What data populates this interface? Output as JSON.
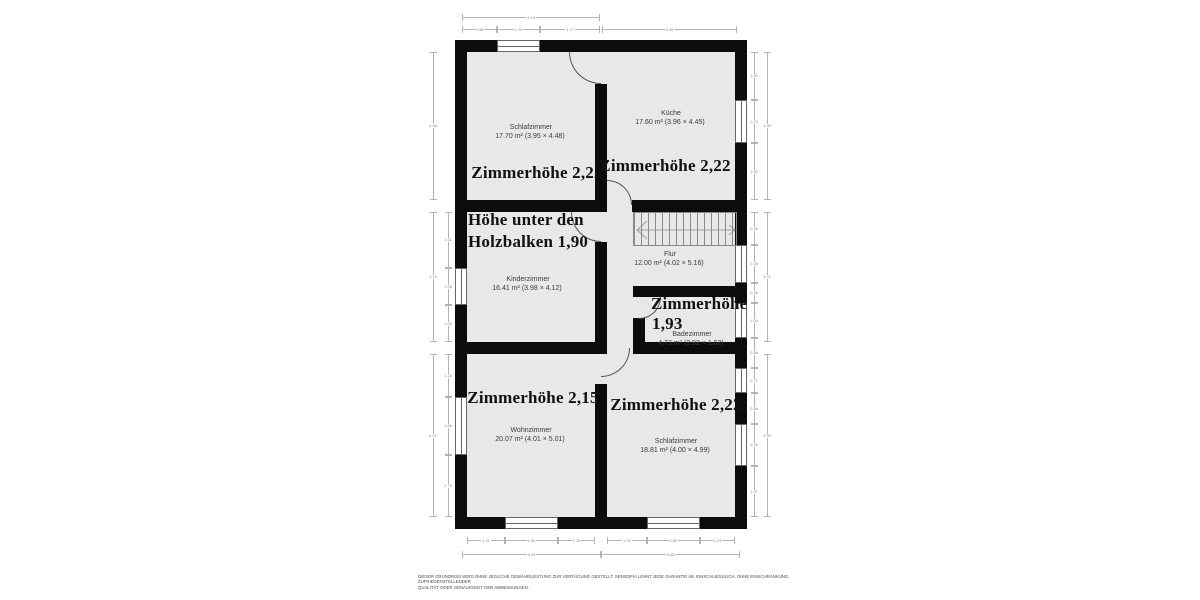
{
  "colors": {
    "wall": "#0c0c0c",
    "room_fill": "#e8e8e8",
    "dimension_line": "#b3b3b3",
    "label_text": "#3a3a3a"
  },
  "rooms": {
    "schlafzimmer_top": {
      "name": "Schlafzimmer",
      "area": "17.70 m² (3.95 × 4.48)",
      "height_note": "Zimmerhöhe 2,22"
    },
    "kueche": {
      "name": "Küche",
      "area": "17.60 m² (3.96 × 4.45)",
      "height_note": "Zimmerhöhe 2,22"
    },
    "kinderzimmer": {
      "name": "Kinderzimmer",
      "area": "16.41 m² (3.98 × 4.12)",
      "height_note_line1": "Höhe unter den",
      "height_note_line2": "Holzbalken 1,90"
    },
    "flur": {
      "name": "Flur",
      "area": "12.00 m² (4.02 × 5.16)"
    },
    "badezimmer": {
      "name": "Badezimmer",
      "area": "4.73 m² (2.92 × 1.62)",
      "height_note_line1": "Zimmerhöhe",
      "height_note_line2": "1,93"
    },
    "wohnzimmer": {
      "name": "Wohnzimmer",
      "area": "20.07 m² (4.01 × 5.01)",
      "height_note": "Zimmerhöhe 2,15"
    },
    "schlafzimmer_bottom": {
      "name": "Schlafzimmer",
      "area": "18.81 m² (4.00 × 4.99)",
      "height_note": "Zimmerhöhe 2,22"
    }
  },
  "dimensions": [
    {
      "o": "h",
      "x": 462,
      "y": 17,
      "l": 138,
      "t": "4.19"
    },
    {
      "o": "h",
      "x": 462,
      "y": 29,
      "l": 35,
      "t": "0.98"
    },
    {
      "o": "h",
      "x": 497,
      "y": 29,
      "l": 43,
      "t": "1.20"
    },
    {
      "o": "h",
      "x": 540,
      "y": 29,
      "l": 60,
      "t": "1.77"
    },
    {
      "o": "h",
      "x": 602,
      "y": 29,
      "l": 135,
      "t": "4.46"
    },
    {
      "o": "v",
      "x": 433,
      "y": 52,
      "l": 148,
      "t": "4.48"
    },
    {
      "o": "v",
      "x": 433,
      "y": 212,
      "l": 130,
      "t": "4.12"
    },
    {
      "o": "v",
      "x": 433,
      "y": 354,
      "l": 163,
      "t": "5.01"
    },
    {
      "o": "v",
      "x": 448,
      "y": 212,
      "l": 56,
      "t": "1.61"
    },
    {
      "o": "v",
      "x": 448,
      "y": 268,
      "l": 37,
      "t": "1.08"
    },
    {
      "o": "v",
      "x": 448,
      "y": 305,
      "l": 37,
      "t": "1.05"
    },
    {
      "o": "v",
      "x": 448,
      "y": 354,
      "l": 43,
      "t": "1.24"
    },
    {
      "o": "v",
      "x": 448,
      "y": 397,
      "l": 58,
      "t": "1.66"
    },
    {
      "o": "v",
      "x": 448,
      "y": 455,
      "l": 62,
      "t": "1.79"
    },
    {
      "o": "v",
      "x": 754,
      "y": 52,
      "l": 48,
      "t": "1.40"
    },
    {
      "o": "v",
      "x": 754,
      "y": 100,
      "l": 43,
      "t": "1.23"
    },
    {
      "o": "v",
      "x": 754,
      "y": 143,
      "l": 57,
      "t": "1.62"
    },
    {
      "o": "v",
      "x": 754,
      "y": 212,
      "l": 33,
      "t": "0.95"
    },
    {
      "o": "v",
      "x": 754,
      "y": 245,
      "l": 38,
      "t": "1.08"
    },
    {
      "o": "v",
      "x": 754,
      "y": 283,
      "l": 20,
      "t": "0.58"
    },
    {
      "o": "v",
      "x": 754,
      "y": 303,
      "l": 35,
      "t": "1.00"
    },
    {
      "o": "v",
      "x": 754,
      "y": 338,
      "l": 30,
      "t": "0.88"
    },
    {
      "o": "v",
      "x": 754,
      "y": 368,
      "l": 25,
      "t": "0.72"
    },
    {
      "o": "v",
      "x": 754,
      "y": 393,
      "l": 31,
      "t": "0.88"
    },
    {
      "o": "v",
      "x": 754,
      "y": 424,
      "l": 42,
      "t": "1.20"
    },
    {
      "o": "v",
      "x": 754,
      "y": 466,
      "l": 51,
      "t": "1.47"
    },
    {
      "o": "v",
      "x": 767,
      "y": 52,
      "l": 148,
      "t": "4.45"
    },
    {
      "o": "v",
      "x": 767,
      "y": 212,
      "l": 130,
      "t": "3.70"
    },
    {
      "o": "v",
      "x": 767,
      "y": 354,
      "l": 163,
      "t": "4.99"
    },
    {
      "o": "h",
      "x": 467,
      "y": 540,
      "l": 38,
      "t": "1.31"
    },
    {
      "o": "h",
      "x": 505,
      "y": 540,
      "l": 53,
      "t": "1.80"
    },
    {
      "o": "h",
      "x": 558,
      "y": 540,
      "l": 37,
      "t": "1.10"
    },
    {
      "o": "h",
      "x": 607,
      "y": 540,
      "l": 40,
      "t": "1.52"
    },
    {
      "o": "h",
      "x": 647,
      "y": 540,
      "l": 53,
      "t": "1.60"
    },
    {
      "o": "h",
      "x": 700,
      "y": 540,
      "l": 35,
      "t": "1.23"
    },
    {
      "o": "h",
      "x": 462,
      "y": 554,
      "l": 139,
      "t": "4.29"
    },
    {
      "o": "h",
      "x": 601,
      "y": 554,
      "l": 139,
      "t": "4.46"
    }
  ],
  "disclaimer": {
    "line1": "DIESER GRUNDRISS WIRD OHNE JEGLICHE GEWÄHRLEISTUNG ZUR VERFÜGUNG GESTELLT. SENSOPIA LEHNT JEDE GARANTIE AB, EINSCHLIESSLICH, OHNE EINSCHRÄNKUNG, ZUFRIEDENSTELLENDER",
    "line2": "QUALITÄT ODER GENAUIGKEIT DER ABMESSUNGEN."
  }
}
